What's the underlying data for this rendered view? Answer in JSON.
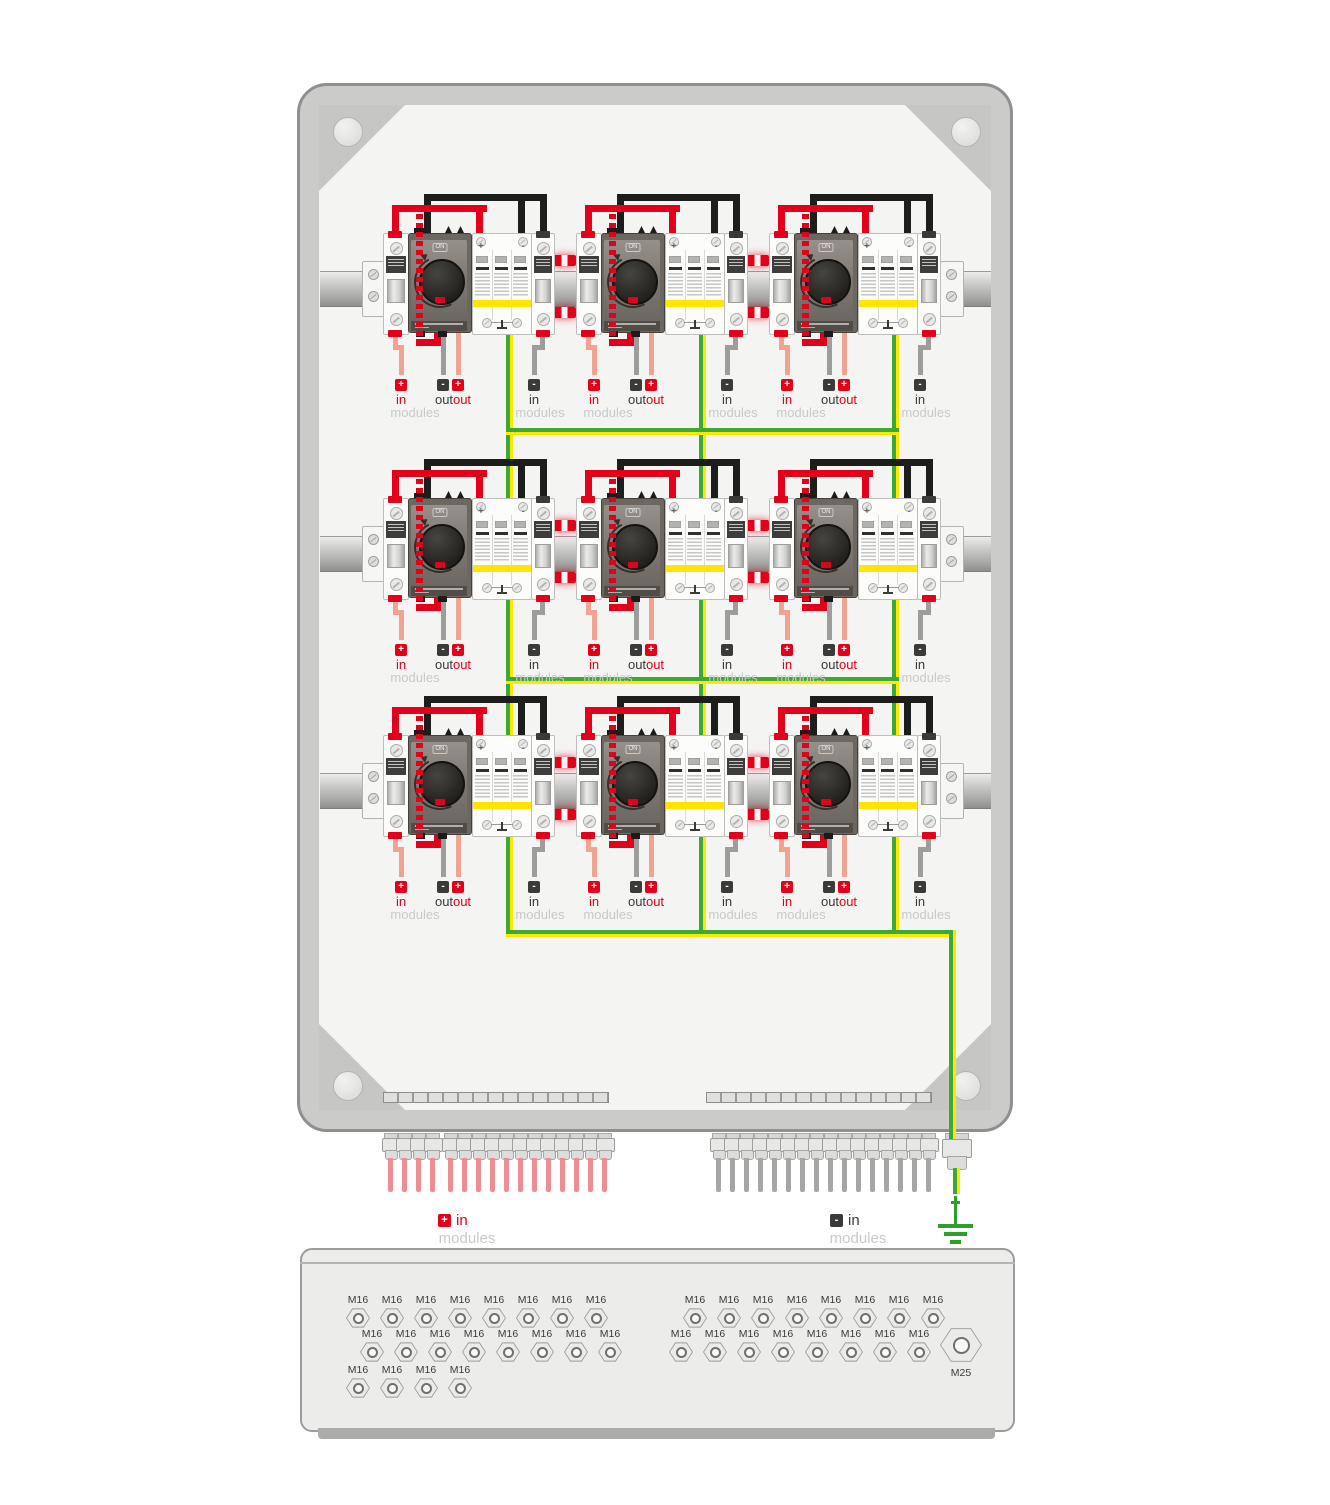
{
  "colors": {
    "red": "#e2001a",
    "salmon": "#f0a48f",
    "wire_gray": "#9d9d9c",
    "black": "#1d1d1b",
    "earth_green": "#3aa935",
    "earth_yellow": "#ffe800",
    "spd_stripe": "#ffe500"
  },
  "unit": {
    "switch_on": "ON",
    "spd_plus": "+",
    "spd_minus": "-",
    "labels": {
      "in_plus": {
        "sign": "+",
        "line1": "in",
        "line2": "modules"
      },
      "out_minus": {
        "sign": "-",
        "label": "out"
      },
      "out_plus": {
        "sign": "+",
        "label": "out"
      },
      "in_minus": {
        "sign": "-",
        "line1": "in",
        "line2": "modules"
      }
    }
  },
  "bottom_wiring": {
    "plus_group": {
      "sign": "+",
      "label": "in",
      "sub": "modules"
    },
    "minus_group": {
      "sign": "-",
      "label": "in",
      "sub": "modules"
    }
  },
  "gland_panel": {
    "m16_label": "M16",
    "m25_label": "M25",
    "left_rows": [
      8,
      8,
      4
    ],
    "right_rows": [
      8,
      8
    ]
  }
}
